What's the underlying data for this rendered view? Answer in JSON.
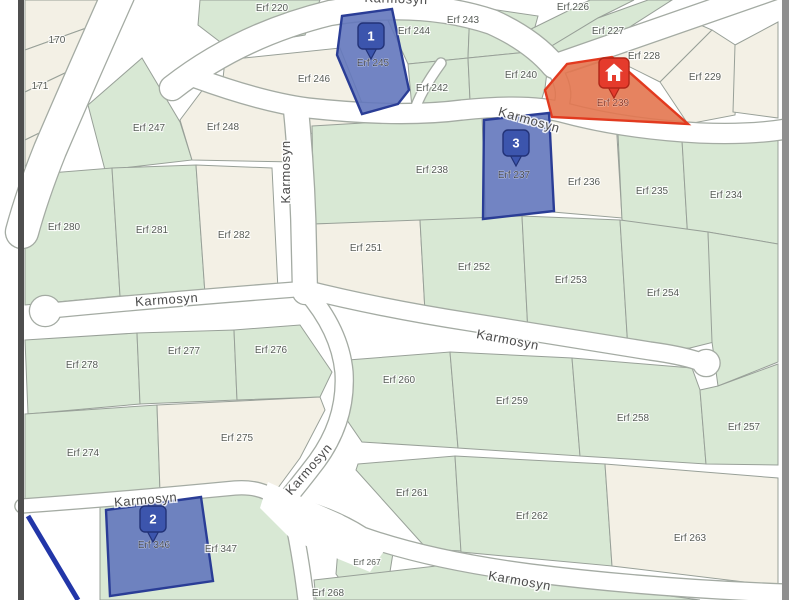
{
  "map": {
    "colors": {
      "green": "#d8e8d4",
      "cream": "#f3f0e5",
      "street": "#ffffff",
      "street_casing": "#a4aba3",
      "parcel_stroke": "#98a098",
      "blue_fill": "#6377bc",
      "blue_stroke": "#2a3d96",
      "orange_fill": "#e3764f",
      "orange_stroke": "#e23a1f",
      "pin_blue": "#3c55ad",
      "pin_blue_stroke": "#223277",
      "pin_red": "#e53b2c",
      "pin_red_stroke": "#b02618",
      "label": "#575c57",
      "street_label": "#4c4c4c",
      "blue_label": "#3e4352",
      "orange_label": "#8a3320",
      "blue_line": "#2236a8",
      "frame_left": "#4f4f4f",
      "frame_right": "#8f8f8f"
    },
    "parcels": [
      {
        "label": "",
        "fill": "cream",
        "pts": "25,0 115,0 103,22 25,50"
      },
      {
        "label": "170",
        "fill": "cream",
        "pts": "25,50 103,22 88,62 25,92",
        "lx": 57,
        "ly": 43
      },
      {
        "label": "171",
        "fill": "cream",
        "pts": "25,92 88,62 70,118 25,140",
        "lx": 40,
        "ly": 89
      },
      {
        "label": "",
        "fill": "cream",
        "pts": "25,140 70,118 48,180 25,196"
      },
      {
        "label": "Erf 220",
        "fill": "green",
        "pts": "200,0 320,0 305,35 228,48 198,25",
        "lx": 272,
        "ly": 11
      },
      {
        "label": "Erf 244",
        "fill": "green",
        "pts": "385,14 470,6 468,58 408,64",
        "lx": 414,
        "ly": 34
      },
      {
        "label": "Erf 243",
        "fill": "green",
        "pts": "470,6 538,16 528,52 468,58",
        "lx": 463,
        "ly": 23
      },
      {
        "label": "Erf 246",
        "fill": "cream",
        "pts": "225,60 340,48 368,118 330,135 250,128 222,88",
        "lx": 314,
        "ly": 82
      },
      {
        "label": "Erf 242",
        "fill": "green",
        "pts": "408,64 468,58 470,100 455,112 412,108",
        "lx": 432,
        "ly": 91
      },
      {
        "label": "Erf 240",
        "fill": "green",
        "pts": "468,58 528,52 548,64 545,88 540,105 470,100",
        "lx": 521,
        "ly": 78
      },
      {
        "label": "Erf 226",
        "fill": "green",
        "pts": "525,32 590,0 634,0 598,18 545,50",
        "lx": 573,
        "ly": 10
      },
      {
        "label": "Erf 227",
        "fill": "green",
        "pts": "545,50 598,18 648,0 672,0 575,62",
        "lx": 608,
        "ly": 34
      },
      {
        "label": "Erf 228",
        "fill": "cream",
        "pts": "570,72 680,16 712,30 660,82 612,58",
        "lx": 644,
        "ly": 59
      },
      {
        "label": "Erf 229",
        "fill": "cream",
        "pts": "660,82 712,30 740,48 735,115 688,124",
        "lx": 705,
        "ly": 80
      },
      {
        "label": "",
        "fill": "cream",
        "pts": "735,45 778,22 778,118 733,112"
      },
      {
        "label": "Erf 247",
        "fill": "green",
        "pts": "88,105 142,58 180,122 192,160 105,170",
        "lx": 149,
        "ly": 131
      },
      {
        "label": "Erf 248",
        "fill": "cream",
        "pts": "180,120 210,80 258,94 292,114 296,162 192,160",
        "lx": 223,
        "ly": 130
      },
      {
        "label": "Erf 238",
        "fill": "green",
        "pts": "312,126 482,116 486,220 314,224",
        "lx": 432,
        "ly": 173
      },
      {
        "label": "Erf 236",
        "fill": "cream",
        "pts": "550,114 616,120 622,218 553,212",
        "lx": 584,
        "ly": 185
      },
      {
        "label": "Erf 235",
        "fill": "green",
        "pts": "618,134 682,140 688,242 622,220",
        "lx": 652,
        "ly": 194
      },
      {
        "label": "Erf 234",
        "fill": "green",
        "pts": "682,140 778,140 778,244 708,232 688,242",
        "lx": 726,
        "ly": 198
      },
      {
        "label": "Erf 280",
        "fill": "green",
        "pts": "25,175 112,168 120,296 25,305",
        "lx": 64,
        "ly": 230
      },
      {
        "label": "Erf 281",
        "fill": "green",
        "pts": "112,168 196,165 205,294 120,296",
        "lx": 152,
        "ly": 233
      },
      {
        "label": "Erf 282",
        "fill": "cream",
        "pts": "196,165 272,168 278,290 205,294",
        "lx": 234,
        "ly": 238
      },
      {
        "label": "Erf 251",
        "fill": "cream",
        "pts": "314,224 420,220 425,312 360,308 316,292",
        "lx": 366,
        "ly": 251
      },
      {
        "label": "Erf 252",
        "fill": "green",
        "pts": "420,220 522,216 528,333 425,312",
        "lx": 474,
        "ly": 270
      },
      {
        "label": "Erf 253",
        "fill": "green",
        "pts": "522,216 620,220 628,350 528,333",
        "lx": 571,
        "ly": 283
      },
      {
        "label": "Erf 254",
        "fill": "green",
        "pts": "620,220 708,232 714,342 690,348 628,350",
        "lx": 663,
        "ly": 296
      },
      {
        "label": "",
        "fill": "green",
        "pts": "708,232 778,244 778,362 718,386 712,342"
      },
      {
        "label": "Erf 278",
        "fill": "green",
        "pts": "25,340 137,333 140,404 28,414",
        "lx": 82,
        "ly": 368
      },
      {
        "label": "Erf 277",
        "fill": "green",
        "pts": "137,333 234,330 237,400 140,404",
        "lx": 184,
        "ly": 354
      },
      {
        "label": "Erf 276",
        "fill": "green",
        "pts": "234,330 300,325 332,372 320,397 237,400",
        "lx": 271,
        "ly": 353
      },
      {
        "label": "Erf 274",
        "fill": "green",
        "pts": "25,414 157,405 160,492 25,503",
        "lx": 83,
        "ly": 456
      },
      {
        "label": "Erf 275",
        "fill": "cream",
        "pts": "157,405 320,397 325,410 300,458 272,496 232,488 160,492",
        "lx": 237,
        "ly": 441
      },
      {
        "label": "Erf 260",
        "fill": "green",
        "pts": "348,360 450,352 458,448 362,442 340,410 342,380",
        "lx": 399,
        "ly": 383
      },
      {
        "label": "Erf 259",
        "fill": "green",
        "pts": "450,352 572,358 580,456 458,448",
        "lx": 512,
        "ly": 404
      },
      {
        "label": "Erf 258",
        "fill": "green",
        "pts": "572,358 692,368 700,390 706,464 580,456",
        "lx": 633,
        "ly": 421
      },
      {
        "label": "Erf 257",
        "fill": "green",
        "pts": "700,390 718,386 778,364 778,465 706,464",
        "lx": 744,
        "ly": 430
      },
      {
        "label": "Erf 261",
        "fill": "green",
        "pts": "358,464 455,456 461,551 427,549 356,470",
        "lx": 412,
        "ly": 496
      },
      {
        "label": "Erf 262",
        "fill": "green",
        "pts": "455,456 605,464 612,566 461,552",
        "lx": 532,
        "ly": 519
      },
      {
        "label": "Erf 263",
        "fill": "cream",
        "pts": "605,464 778,478 778,586 612,566",
        "lx": 690,
        "ly": 541
      },
      {
        "label": "Erf 347",
        "fill": "green",
        "pts": "100,500 264,491 280,510 302,556 312,600 100,600",
        "lx": 221,
        "ly": 552
      },
      {
        "label": "Erf 267",
        "fill": "green",
        "pts": "338,549 370,541 393,553 389,578 352,596 336,574",
        "lx": 367,
        "ly": 565,
        "fs": 8.5
      },
      {
        "label": "Erf 268",
        "fill": "green",
        "pts": "314,580 445,565 560,582 640,592 700,600 316,600",
        "lx": 328,
        "ly": 596
      }
    ],
    "streets": [
      {
        "name": "street-topleft-diagonal",
        "path": "M 118,-5 Q 80,80 50,150 Q 32,195 22,232",
        "w": 32
      },
      {
        "name": "street-karmosyn-top",
        "path": "M 172,88 Q 240,35 330,13 Q 420,-2 492,22 Q 532,40 554,66",
        "w": 24
      },
      {
        "name": "street-karmosyn-top-east",
        "path": "M 552,66 L 782,-14",
        "w": 21
      },
      {
        "name": "street-connector",
        "path": "M 552,66 Q 568,88 561,106",
        "w": 14
      },
      {
        "name": "street-karmosyn-upper",
        "path": "M 196,78 Q 262,102 308,108 Q 400,118 462,110 Q 530,103 565,113 Q 625,129 700,133 Q 752,135 786,129",
        "w": 19
      },
      {
        "name": "street-karmosyn-vertical",
        "path": "M 296,110 Q 303,180 304,250 L 305,292",
        "w": 24
      },
      {
        "name": "street-karmosyn-left",
        "path": "M 45,311 Q 170,299 302,289",
        "w": 14
      },
      {
        "name": "bulb-left",
        "path": "M 45,311 L 45.5,311",
        "w": 30
      },
      {
        "name": "street-karmosyn-middle",
        "path": "M 304,289 Q 380,308 470,322 Q 580,340 650,351 Q 680,355 698,361",
        "w": 17
      },
      {
        "name": "bulb-right",
        "path": "M 706,363 L 706.5,363",
        "w": 26
      },
      {
        "name": "street-karmosyn-diagonal",
        "path": "M 306,291 Q 340,330 344,372 Q 347,420 317,461 Q 298,486 281,506",
        "w": 17
      },
      {
        "name": "street-karmosyn-bottomleft",
        "path": "M 22,506 Q 120,499 235,488 Q 262,486 278,500",
        "w": 13
      },
      {
        "name": "street-karmosyn-bottom",
        "path": "M 278,503 Q 330,515 362,536 Q 430,560 530,573 Q 650,588 784,593",
        "w": 17
      },
      {
        "name": "street-south-stub",
        "path": "M 290,507 Q 300,550 306,600",
        "w": 15
      },
      {
        "name": "street-lane-stub",
        "path": "M 441,63 Q 420,92 414,112",
        "w": 9
      }
    ],
    "patches": [
      "268,482 342,515 388,545 370,572 292,540 260,508"
    ],
    "highlights": [
      {
        "label": "Erf 239",
        "fill": "orange_fill",
        "stroke": "orange_stroke",
        "lcolor": "orange_label",
        "pts": "545,90 567,64 612,57 688,124 652,122 552,117",
        "lx": 613,
        "ly": 106
      },
      {
        "label": "Erf 245",
        "fill": "blue_fill",
        "stroke": "blue_stroke",
        "lcolor": "blue_label",
        "pts": "342,16 392,9 409,90 398,104 362,114 337,55",
        "lx": 373,
        "ly": 66
      },
      {
        "label": "Erf 237",
        "fill": "blue_fill",
        "stroke": "blue_stroke",
        "lcolor": "blue_label",
        "pts": "484,120 549,113 554,211 483,219",
        "lx": 514,
        "ly": 178
      },
      {
        "label": "Erf 346",
        "fill": "blue_fill",
        "stroke": "blue_stroke",
        "lcolor": "blue_label",
        "pts": "106,510 201,497 213,581 110,596",
        "lx": 154,
        "ly": 548
      }
    ],
    "street_labels": [
      {
        "text": "Karmosyn",
        "x": 396,
        "y": 3,
        "rot": 2,
        "name": "street-label-karmosyn-top"
      },
      {
        "text": "Karmosyn",
        "x": 528,
        "y": 124,
        "rot": 16,
        "name": "street-label-karmosyn-upper"
      },
      {
        "text": "Karmosyn",
        "x": 290,
        "y": 172,
        "rot": -90,
        "name": "street-label-karmosyn-vertical"
      },
      {
        "text": "Karmosyn",
        "x": 167,
        "y": 304,
        "rot": -4,
        "name": "street-label-karmosyn-left"
      },
      {
        "text": "Karmosyn",
        "x": 507,
        "y": 344,
        "rot": 11,
        "name": "street-label-karmosyn-middle"
      },
      {
        "text": "Karmosyn",
        "x": 312,
        "y": 472,
        "rot": -49,
        "name": "street-label-karmosyn-diagonal"
      },
      {
        "text": "Karmosyn",
        "x": 146,
        "y": 504,
        "rot": -5,
        "name": "street-label-karmosyn-bottomleft"
      },
      {
        "text": "Karmosyn",
        "x": 519,
        "y": 585,
        "rot": 10,
        "name": "street-label-karmosyn-bottom"
      }
    ],
    "markers": [
      {
        "kind": "number",
        "value": "1",
        "x": 371,
        "y": 36,
        "name": "marker-pin-1"
      },
      {
        "kind": "number",
        "value": "3",
        "x": 516,
        "y": 143,
        "name": "marker-pin-3"
      },
      {
        "kind": "number",
        "value": "2",
        "x": 153,
        "y": 519,
        "name": "marker-pin-2"
      },
      {
        "kind": "house",
        "value": "",
        "x": 614,
        "y": 73,
        "name": "marker-pin-house"
      }
    ],
    "extra_lines": [
      {
        "x1": 28,
        "y1": 516,
        "x2": 78,
        "y2": 600,
        "w": 5,
        "color": "blue_line",
        "name": "servitude-blue-line"
      }
    ],
    "frame": [
      {
        "x": 18,
        "w": 6,
        "color": "frame_left",
        "name": "map-frame-left"
      },
      {
        "x": 782,
        "w": 7,
        "color": "frame_right",
        "name": "map-frame-right"
      },
      {
        "x": 789,
        "w": 11,
        "color": "street",
        "name": "map-margin-right"
      }
    ]
  }
}
